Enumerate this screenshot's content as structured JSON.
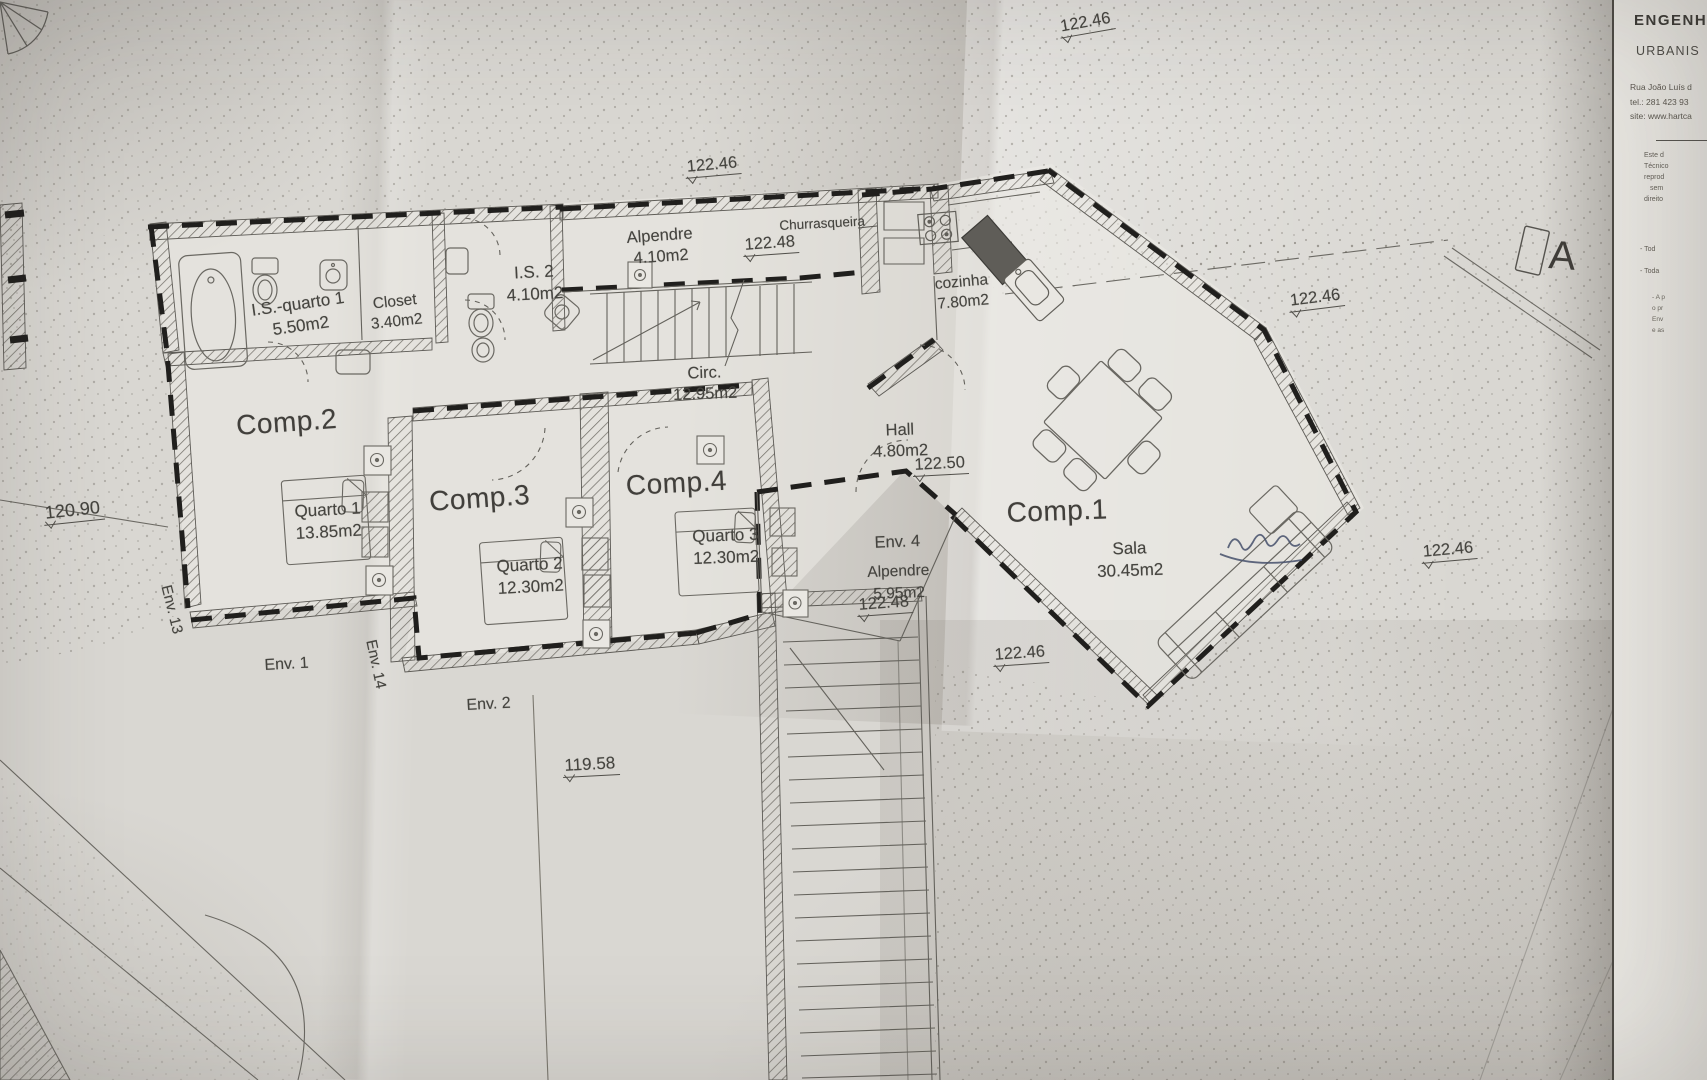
{
  "document_type": "architectural floor plan photograph",
  "colors": {
    "paper": "#d9d7d2",
    "ink": "#55534e",
    "insulation_dash": "#201f1d",
    "pen_scribble": "#46506b"
  },
  "section_marker": "A",
  "title_block": {
    "line1": "ENGENHA",
    "line2": "URBANIS",
    "address": "Rua João Luís d",
    "tel": "tel.: 281 423 93",
    "site": "site: www.hartca",
    "fine_print": [
      "Este d",
      "Técnico",
      "reprod",
      "sem",
      "direito"
    ],
    "notes": [
      "- Tod",
      "- Toda"
    ],
    "tiny_notes": [
      "- A p",
      "o pr",
      "Env",
      "e as"
    ]
  },
  "rooms": {
    "comp1": {
      "label": "Comp.1"
    },
    "comp2": {
      "label": "Comp.2"
    },
    "comp3": {
      "label": "Comp.3"
    },
    "comp4": {
      "label": "Comp.4"
    },
    "quarto1": {
      "name": "Quarto 1",
      "area": "13.85m2"
    },
    "quarto2": {
      "name": "Quarto 2",
      "area": "12.30m2"
    },
    "quarto3": {
      "name": "Quarto 3",
      "area": "12.30m2"
    },
    "sala": {
      "name": "Sala",
      "area": "30.45m2"
    },
    "is_quarto1": {
      "name": "I.S.-quarto 1",
      "area": "5.50m2"
    },
    "closet": {
      "name": "Closet",
      "area": "3.40m2"
    },
    "is2": {
      "name": "I.S. 2",
      "area": "4.10m2"
    },
    "alpendre_top": {
      "name": "Alpendre",
      "area": "4.10m2"
    },
    "churrasqueira": {
      "name": "Churrasqueira"
    },
    "cozinha": {
      "name": "cozinha",
      "area": "7.80m2"
    },
    "circ": {
      "name": "Circ.",
      "area": "12.95m2"
    },
    "hall": {
      "name": "Hall",
      "area": "4.80m2"
    },
    "env4": {
      "name": "Env. 4",
      "sub": "Alpendre",
      "area": "5.95m2"
    }
  },
  "envelopes": {
    "env1": "Env. 1",
    "env2": "Env. 2",
    "env13": "Env. 13",
    "env14": "Env. 14"
  },
  "elevations": {
    "top_center": "122.46",
    "top_right": "122.46",
    "alpendre": "122.48",
    "hall": "122.50",
    "mid_right": "122.46",
    "right_side": "122.46",
    "env4": "122.48",
    "below_env4": "122.46",
    "left_side": "120.90",
    "bottom": "119.58"
  }
}
